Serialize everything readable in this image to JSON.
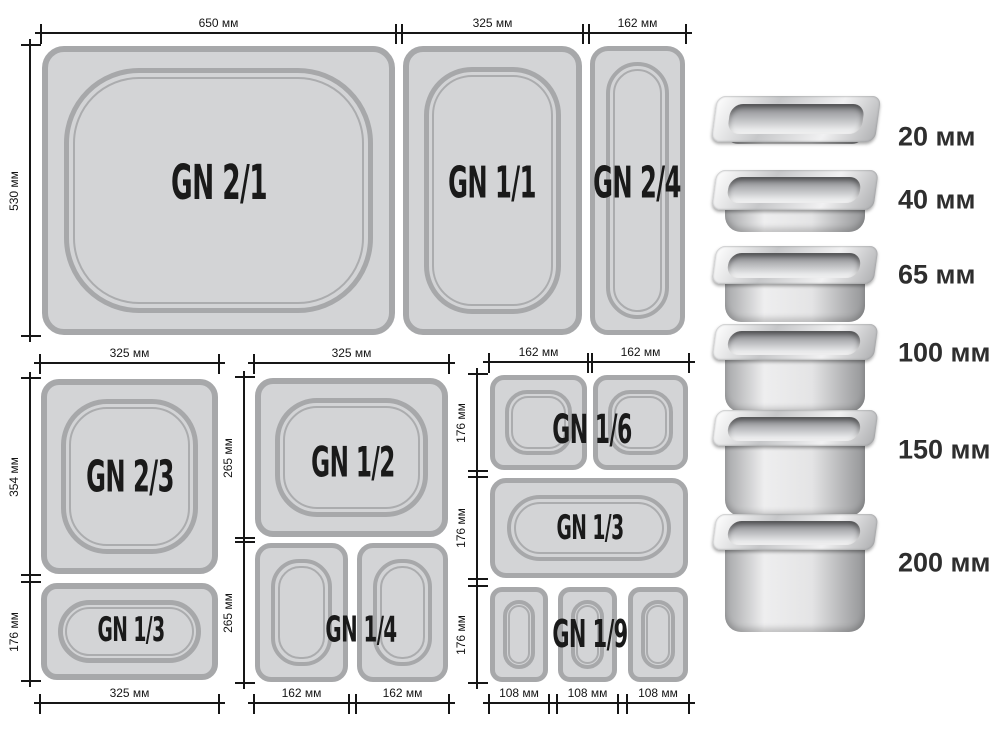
{
  "diagram": {
    "pans": {
      "gn21": "GN 2/1",
      "gn11": "GN 1/1",
      "gn24": "GN 2/4",
      "gn23": "GN 2/3",
      "gn13_left": "GN 1/3",
      "gn12": "GN 1/2",
      "gn14": "GN 1/4",
      "gn16": "GN 1/6",
      "gn13_right": "GN 1/3",
      "gn19": "GN 1/9"
    },
    "dims": {
      "g1_top": [
        "650 мм",
        "325 мм",
        "162 мм"
      ],
      "g1_left": [
        "530 мм"
      ],
      "g2_top": [
        "325 мм"
      ],
      "g2_left": [
        "354 мм",
        "176 мм"
      ],
      "g2_bottom": [
        "325 мм"
      ],
      "g3_top": [
        "325 мм"
      ],
      "g3_left": [
        "265 мм",
        "265 мм"
      ],
      "g3_bottom": [
        "162 мм",
        "162 мм"
      ],
      "g4_top": [
        "162 мм",
        "162 мм"
      ],
      "g4_left": [
        "176 мм",
        "176 мм",
        "176 мм"
      ],
      "g4_bottom": [
        "108 мм",
        "108 мм",
        "108 мм"
      ]
    }
  },
  "depth_legend": [
    "20 мм",
    "40 мм",
    "65 мм",
    "100 мм",
    "150 мм",
    "200 мм"
  ],
  "colors": {
    "pan_fill": "#d3d4d6",
    "pan_border": "#a7a8aa",
    "dim_line": "#161616",
    "label_text": "#1a1a1a"
  }
}
